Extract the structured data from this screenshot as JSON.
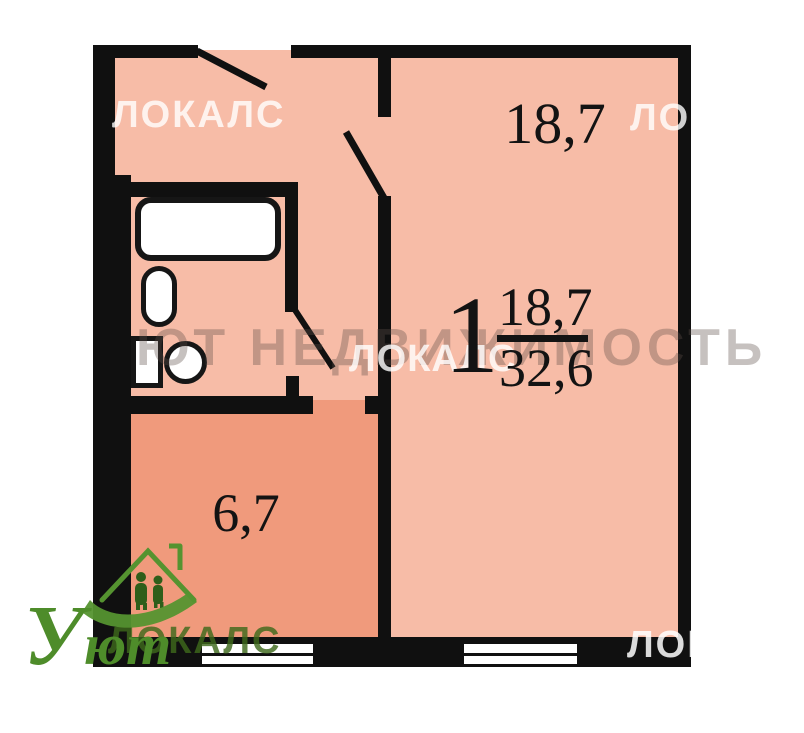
{
  "plan": {
    "rooms": [
      {
        "name": "room",
        "area_label": "18,7"
      },
      {
        "name": "kitchen",
        "area_label": "6,7"
      }
    ],
    "summary": {
      "rooms_count": "1",
      "living_area": "18,7",
      "total_area": "32,6"
    }
  },
  "watermarks": {
    "locals": "ЛОКАЛС",
    "agency": "ЮТ НЕДВИЖИМОСТЬ",
    "logo_initial": "У",
    "logo_rest": "ют"
  },
  "colors": {
    "room_fill": "#f7bca7",
    "kitchen_fill": "#f09a7c",
    "wall": "#101010",
    "logo_green": "#559330"
  }
}
